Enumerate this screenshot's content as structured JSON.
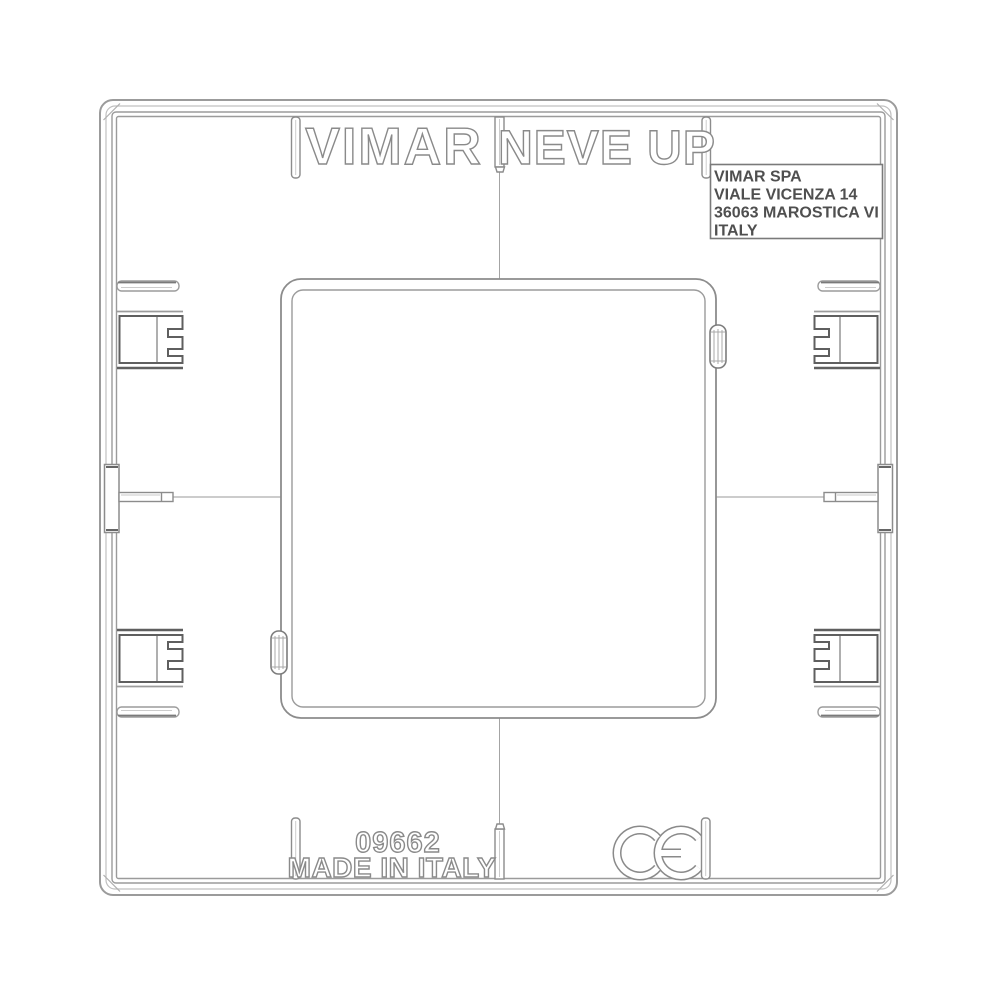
{
  "drawing": {
    "brand": "VIMAR",
    "series": "NEVE UP",
    "address_label": {
      "line1": "VIMAR SPA",
      "line2": "VIALE VICENZA 14",
      "line3": "36063 MAROSTICA VI",
      "line4": "ITALY"
    },
    "part_number": "09662",
    "origin": "MADE IN ITALY",
    "certification_mark": "CE"
  },
  "colors": {
    "background": "#ffffff",
    "line_light": "#c6c6c6",
    "line_main": "#9b9b9b",
    "line_dark": "#5f5f5f",
    "text_outline": "#8a8a8a",
    "label_text": "#4f4f4f"
  }
}
